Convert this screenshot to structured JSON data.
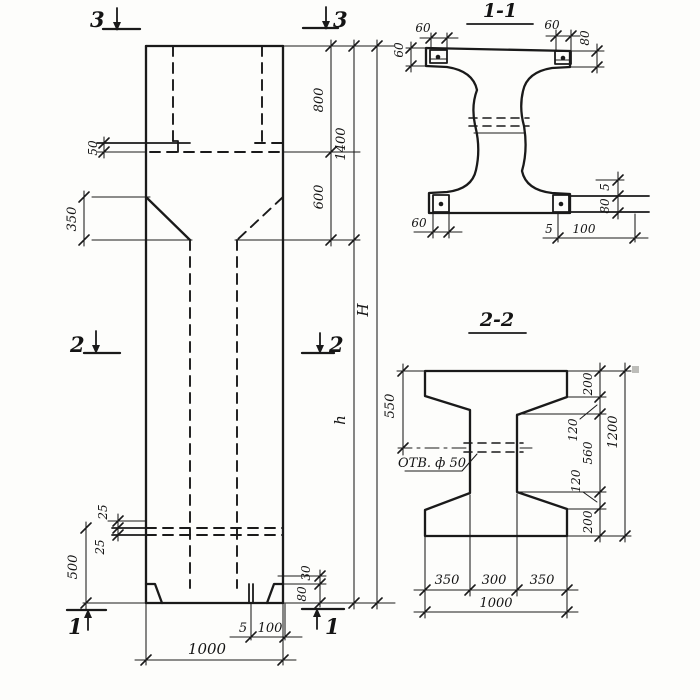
{
  "style": {
    "ink": "#1a1a1a",
    "paper": "#fdfdfb"
  },
  "elevation": {
    "markers": {
      "top_left": "3",
      "top_right": "3",
      "mid_left": "2",
      "mid_right": "2",
      "bottom_left": "1",
      "bottom_right": "1"
    },
    "dims": {
      "step_50": "50",
      "haunch_350": "350",
      "top_800": "800",
      "mid_600": "600",
      "top_total_1400": "1400",
      "total_H": "H",
      "shaft_h": "h",
      "spacer_25_top": "25",
      "spacer_25_bottom": "25",
      "base_500": "500",
      "foot_30": "30",
      "foot_80": "80",
      "plate_5": "5",
      "plate_100": "100",
      "width_1000": "1000"
    }
  },
  "section_1_1": {
    "title": "1-1",
    "dims": {
      "top_left_60": "60",
      "tip_left_60": "60",
      "top_right_60": "60",
      "tip_right_80": "80",
      "bottom_left_60": "60",
      "edge_5": "5",
      "edge_80": "80",
      "bottom_5": "5",
      "bottom_100": "100"
    }
  },
  "section_2_2": {
    "title": "2-2",
    "hole_label": "ОТВ. ф 50",
    "dims": {
      "left_550": "550",
      "right_200_top": "200",
      "right_120_top": "120",
      "right_560": "560",
      "right_120_bottom": "120",
      "right_200_bottom": "200",
      "right_total_1200": "1200",
      "bottom_350_left": "350",
      "bottom_300": "300",
      "bottom_350_right": "350",
      "bottom_total_1000": "1000"
    }
  }
}
